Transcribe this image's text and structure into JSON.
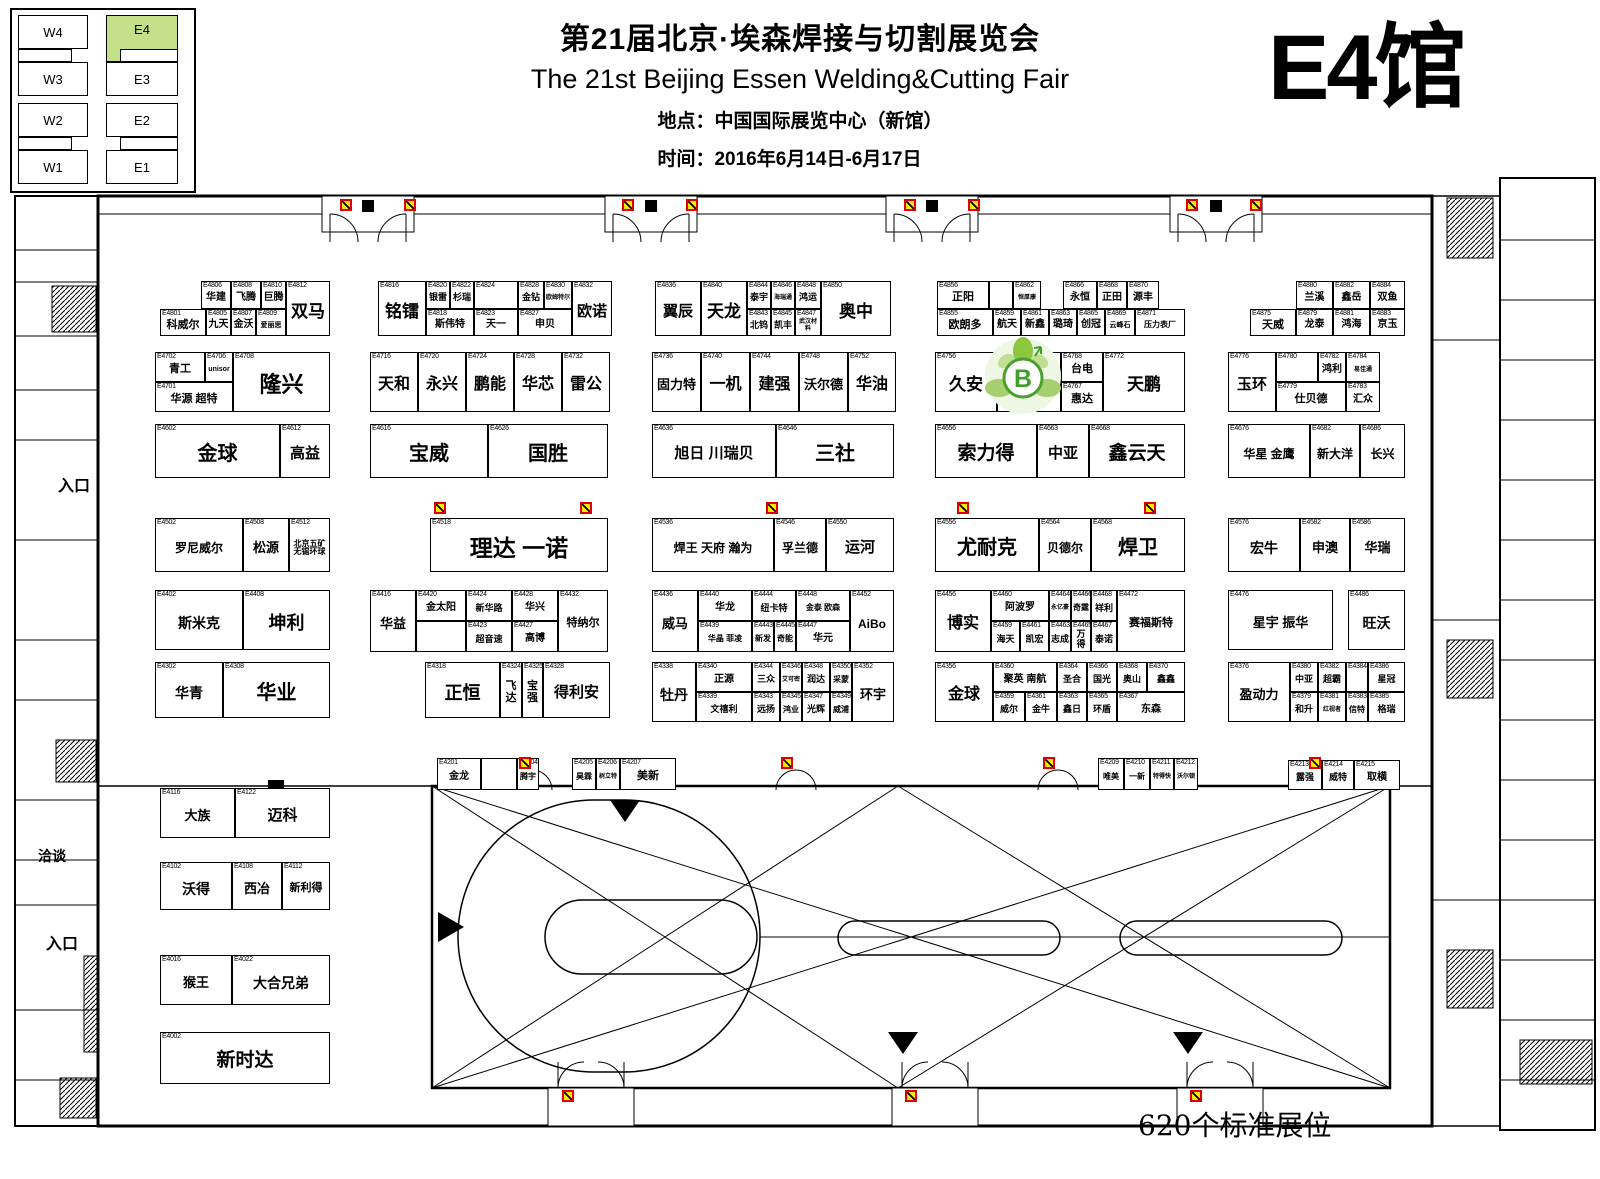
{
  "header": {
    "title_cn": "第21届北京·埃森焊接与切割展览会",
    "title_en": "The 21st Beijing Essen Welding&Cutting Fair",
    "location": "地点：中国国际展览中心（新馆）",
    "dates": "时间：2016年6月14日-6月17日",
    "hall_label": "E4馆"
  },
  "minimap": {
    "halls": [
      {
        "label": "W4"
      },
      {
        "label": "W3"
      },
      {
        "label": "W2"
      },
      {
        "label": "W1"
      },
      {
        "label": "E4"
      },
      {
        "label": "E3"
      },
      {
        "label": "E2"
      },
      {
        "label": "E1"
      }
    ],
    "highlight": "E4"
  },
  "labels": {
    "entrance_top": "入口",
    "meeting": "洽谈",
    "entrance_bottom": "入口",
    "booth_count": "620个标准展位"
  },
  "colors": {
    "minimap_highlight": "#c4e189",
    "hydrant_yellow": "#ffe800",
    "hydrant_red": "#e10000",
    "logo_green": "#7ab648"
  },
  "booths": [
    [
      "E4806",
      "华建",
      201,
      281,
      30,
      28,
      10
    ],
    [
      "E4808",
      "飞腾",
      231,
      281,
      30,
      28,
      10
    ],
    [
      "E4810",
      "巨腾",
      261,
      281,
      25,
      28,
      10
    ],
    [
      "E4812",
      "双马",
      286,
      281,
      44,
      55,
      17
    ],
    [
      "E4801",
      "科威尔",
      160,
      309,
      46,
      27,
      11
    ],
    [
      "E4805",
      "九天",
      206,
      309,
      25,
      27,
      10
    ],
    [
      "E4807",
      "金沃",
      231,
      309,
      25,
      27,
      10
    ],
    [
      "E4809",
      "爱丽思",
      256,
      309,
      30,
      27,
      7
    ],
    [
      "E4816",
      "铭镭",
      378,
      281,
      48,
      55,
      17
    ],
    [
      "E4820",
      "银雷",
      426,
      281,
      24,
      28,
      9
    ],
    [
      "E4822",
      "杉瑞",
      450,
      281,
      24,
      28,
      9
    ],
    [
      "E4824",
      "",
      474,
      281,
      44,
      28,
      9
    ],
    [
      "E4828",
      "金钻",
      518,
      281,
      26,
      28,
      9
    ],
    [
      "E4830",
      "欧姆特尔",
      544,
      281,
      28,
      28,
      6
    ],
    [
      "E4818",
      "斯伟特",
      426,
      309,
      48,
      27,
      10
    ],
    [
      "E4823",
      "天一",
      474,
      309,
      44,
      27,
      10
    ],
    [
      "E4827",
      "申贝",
      518,
      309,
      54,
      27,
      10
    ],
    [
      "E4832",
      "欧诺",
      572,
      281,
      40,
      55,
      15
    ],
    [
      "E4836",
      "翼辰",
      655,
      281,
      46,
      55,
      15
    ],
    [
      "E4840",
      "天龙",
      701,
      281,
      46,
      55,
      17
    ],
    [
      "E4844",
      "泰宇",
      747,
      281,
      24,
      28,
      9
    ],
    [
      "E4846",
      "海瑞通",
      771,
      281,
      24,
      28,
      6
    ],
    [
      "E4848",
      "鸿运",
      795,
      281,
      26,
      28,
      9
    ],
    [
      "E4843",
      "北钨",
      747,
      309,
      24,
      27,
      9
    ],
    [
      "E4845",
      "凯丰",
      771,
      309,
      24,
      27,
      9
    ],
    [
      "E4847",
      "武汉材料",
      795,
      309,
      26,
      27,
      6
    ],
    [
      "E4850",
      "奥中",
      821,
      281,
      70,
      55,
      17
    ],
    [
      "E4856",
      "正阳",
      937,
      281,
      52,
      28,
      11
    ],
    [
      "",
      "",
      989,
      281,
      24,
      28,
      9
    ],
    [
      "E4862",
      "恒厚康",
      1013,
      281,
      28,
      28,
      6
    ],
    [
      "E4866",
      "永恒",
      1063,
      281,
      34,
      28,
      10
    ],
    [
      "E4868",
      "正田",
      1097,
      281,
      30,
      28,
      10
    ],
    [
      "E4870",
      "源丰",
      1127,
      281,
      32,
      28,
      10
    ],
    [
      "E4855",
      "欧朗多",
      937,
      309,
      56,
      27,
      11
    ],
    [
      "E4859",
      "航天",
      993,
      309,
      28,
      27,
      10
    ],
    [
      "E4861",
      "新鑫",
      1021,
      309,
      28,
      27,
      10
    ],
    [
      "E4863",
      "璐琦",
      1049,
      309,
      28,
      27,
      10
    ],
    [
      "E4865",
      "创冠",
      1077,
      309,
      28,
      27,
      10
    ],
    [
      "E4869",
      "云峰石",
      1105,
      309,
      30,
      27,
      7
    ],
    [
      "E4871",
      "压力表厂",
      1135,
      309,
      50,
      27,
      8
    ],
    [
      "E4880",
      "兰溪",
      1296,
      281,
      37,
      28,
      10
    ],
    [
      "E4882",
      "鑫岳",
      1333,
      281,
      37,
      28,
      10
    ],
    [
      "E4884",
      "双鱼",
      1370,
      281,
      35,
      28,
      10
    ],
    [
      "E4875",
      "天威",
      1250,
      309,
      46,
      27,
      11
    ],
    [
      "E4879",
      "龙泰",
      1296,
      309,
      37,
      27,
      10
    ],
    [
      "E4881",
      "鸿海",
      1333,
      309,
      37,
      27,
      10
    ],
    [
      "E4883",
      "京玉",
      1370,
      309,
      35,
      27,
      10
    ],
    [
      "E4702",
      "青工",
      155,
      352,
      50,
      30,
      11
    ],
    [
      "E4706",
      "unisor",
      205,
      352,
      28,
      30,
      7
    ],
    [
      "E4701",
      "华源 超特",
      155,
      382,
      78,
      30,
      11
    ],
    [
      "E4708",
      "隆兴",
      233,
      352,
      97,
      60,
      22
    ],
    [
      "E4716",
      "天和",
      370,
      352,
      48,
      60,
      16
    ],
    [
      "E4720",
      "永兴",
      418,
      352,
      48,
      60,
      16
    ],
    [
      "E4724",
      "鹏能",
      466,
      352,
      48,
      60,
      16
    ],
    [
      "E4728",
      "华芯",
      514,
      352,
      48,
      60,
      16
    ],
    [
      "E4732",
      "雷公",
      562,
      352,
      48,
      60,
      16
    ],
    [
      "E4736",
      "固力特",
      652,
      352,
      49,
      60,
      13
    ],
    [
      "E4740",
      "一机",
      701,
      352,
      49,
      60,
      16
    ],
    [
      "E4744",
      "建强",
      750,
      352,
      49,
      60,
      16
    ],
    [
      "E4748",
      "沃尔德",
      799,
      352,
      49,
      60,
      13
    ],
    [
      "E4752",
      "华油",
      848,
      352,
      48,
      60,
      16
    ],
    [
      "E4756",
      "久安",
      935,
      352,
      62,
      60,
      17
    ],
    [
      "",
      "",
      997,
      352,
      64,
      60,
      10
    ],
    [
      "E4768",
      "台电",
      1061,
      352,
      42,
      30,
      11
    ],
    [
      "E4767",
      "惠达",
      1061,
      382,
      42,
      30,
      11
    ],
    [
      "E4772",
      "天鹏",
      1103,
      352,
      82,
      60,
      17
    ],
    [
      "E4776",
      "玉环",
      1228,
      352,
      48,
      60,
      15
    ],
    [
      "E4780",
      "",
      1276,
      352,
      42,
      30,
      10
    ],
    [
      "E4782",
      "鸿利",
      1318,
      352,
      28,
      30,
      10
    ],
    [
      "E4784",
      "易佳通",
      1346,
      352,
      34,
      30,
      6
    ],
    [
      "E4779",
      "仕贝德",
      1276,
      382,
      70,
      30,
      11
    ],
    [
      "E4783",
      "汇众",
      1346,
      382,
      34,
      30,
      10
    ],
    [
      "E4602",
      "金球",
      155,
      424,
      125,
      54,
      20
    ],
    [
      "E4612",
      "高益",
      280,
      424,
      50,
      54,
      15
    ],
    [
      "E4616",
      "宝威",
      370,
      424,
      118,
      54,
      20
    ],
    [
      "E4626",
      "国胜",
      488,
      424,
      120,
      54,
      20
    ],
    [
      "E4636",
      "旭日 川瑞贝",
      652,
      424,
      124,
      54,
      15
    ],
    [
      "E4646",
      "三社",
      776,
      424,
      118,
      54,
      20
    ],
    [
      "E4656",
      "索力得",
      935,
      424,
      102,
      54,
      19
    ],
    [
      "E4663",
      "中亚",
      1037,
      424,
      52,
      54,
      15
    ],
    [
      "E4668",
      "鑫云天",
      1089,
      424,
      96,
      54,
      19
    ],
    [
      "E4676",
      "华星 金鹰",
      1228,
      424,
      82,
      54,
      12
    ],
    [
      "E4682",
      "新大洋",
      1310,
      424,
      50,
      54,
      12
    ],
    [
      "E4686",
      "长兴",
      1360,
      424,
      45,
      54,
      12
    ],
    [
      "E4502",
      "罗尼威尔",
      155,
      518,
      88,
      54,
      12
    ],
    [
      "E4508",
      "松源",
      243,
      518,
      46,
      54,
      13
    ],
    [
      "E4512",
      "北京五矿 无锡环球",
      289,
      518,
      41,
      54,
      8
    ],
    [
      "E4518",
      "理达 一诺",
      430,
      518,
      178,
      54,
      23
    ],
    [
      "E4536",
      "焊王 天府 瀚为",
      652,
      518,
      122,
      54,
      12
    ],
    [
      "E4546",
      "孚兰德",
      774,
      518,
      52,
      54,
      12
    ],
    [
      "E4550",
      "运河",
      826,
      518,
      68,
      54,
      15
    ],
    [
      "E4556",
      "尤耐克",
      935,
      518,
      104,
      54,
      20
    ],
    [
      "E4564",
      "贝德尔",
      1039,
      518,
      52,
      54,
      12
    ],
    [
      "E4568",
      "焊卫",
      1091,
      518,
      94,
      54,
      20
    ],
    [
      "E4576",
      "宏牛",
      1228,
      518,
      72,
      54,
      14
    ],
    [
      "E4582",
      "申澳",
      1300,
      518,
      50,
      54,
      13
    ],
    [
      "E4586",
      "华瑞",
      1350,
      518,
      55,
      54,
      13
    ],
    [
      "E4402",
      "斯米克",
      155,
      590,
      88,
      60,
      14
    ],
    [
      "E4408",
      "坤利",
      243,
      590,
      87,
      60,
      18
    ],
    [
      "E4416",
      "华益",
      370,
      590,
      46,
      62,
      13
    ],
    [
      "E4420",
      "金太阳",
      416,
      590,
      50,
      31,
      10
    ],
    [
      "E4424",
      "新华路",
      466,
      590,
      46,
      31,
      9
    ],
    [
      "E4428",
      "华兴",
      512,
      590,
      46,
      31,
      10
    ],
    [
      "",
      "",
      416,
      621,
      50,
      31,
      9
    ],
    [
      "E4423",
      "超音速",
      466,
      621,
      46,
      31,
      9
    ],
    [
      "E4427",
      "高博",
      512,
      621,
      46,
      31,
      10
    ],
    [
      "E4432",
      "特纳尔",
      558,
      590,
      50,
      62,
      11
    ],
    [
      "E4436",
      "威马",
      652,
      590,
      46,
      62,
      13
    ],
    [
      "E4440",
      "华龙",
      698,
      590,
      54,
      31,
      10
    ],
    [
      "E4444",
      "纽卡特",
      752,
      590,
      44,
      31,
      9
    ],
    [
      "E4448",
      "金泰 欧森",
      796,
      590,
      54,
      31,
      8
    ],
    [
      "E4439",
      "华晶 菲凌",
      698,
      621,
      54,
      31,
      8
    ],
    [
      "E4443",
      "新发",
      752,
      621,
      22,
      31,
      8
    ],
    [
      "E4445",
      "奇能",
      774,
      621,
      22,
      31,
      8
    ],
    [
      "E4447",
      "华元",
      796,
      621,
      54,
      31,
      10
    ],
    [
      "E4452",
      "AiBo",
      850,
      590,
      44,
      62,
      12
    ],
    [
      "E4456",
      "博实",
      935,
      590,
      56,
      62,
      16
    ],
    [
      "E4460",
      "阿波罗",
      991,
      590,
      58,
      31,
      10
    ],
    [
      "E4464",
      "永亿豪",
      1049,
      590,
      22,
      31,
      6
    ],
    [
      "E4466",
      "奇霆",
      1071,
      590,
      20,
      31,
      8
    ],
    [
      "E4468",
      "祥利",
      1091,
      590,
      26,
      31,
      9
    ],
    [
      "E4459",
      "海天",
      991,
      621,
      29,
      31,
      9
    ],
    [
      "E4461",
      "凯宏",
      1020,
      621,
      29,
      31,
      9
    ],
    [
      "E4463",
      "志成",
      1049,
      621,
      22,
      31,
      9
    ],
    [
      "E4465",
      "万得",
      1071,
      621,
      20,
      31,
      9
    ],
    [
      "E4467",
      "泰诺",
      1091,
      621,
      26,
      31,
      9
    ],
    [
      "E4472",
      "赛福斯特",
      1117,
      590,
      68,
      62,
      11
    ],
    [
      "E4476",
      "星宇 振华",
      1228,
      590,
      105,
      60,
      13
    ],
    [
      "E4486",
      "旺沃",
      1348,
      590,
      57,
      60,
      14
    ],
    [
      "E4302",
      "华青",
      155,
      662,
      68,
      56,
      14
    ],
    [
      "E4308",
      "华业",
      223,
      662,
      107,
      56,
      20
    ],
    [
      "E4318",
      "正恒",
      425,
      662,
      75,
      56,
      18
    ],
    [
      "E4324",
      "飞达",
      500,
      662,
      22,
      56,
      11
    ],
    [
      "E4325",
      "宝强",
      522,
      662,
      21,
      56,
      11
    ],
    [
      "E4328",
      "得利安",
      543,
      662,
      67,
      56,
      15
    ],
    [
      "E4338",
      "牡丹",
      652,
      662,
      44,
      60,
      14
    ],
    [
      "E4340",
      "正源",
      696,
      662,
      56,
      30,
      10
    ],
    [
      "E4344",
      "三众",
      752,
      662,
      28,
      30,
      9
    ],
    [
      "E4346",
      "艾可密",
      780,
      662,
      22,
      30,
      6
    ],
    [
      "E4348",
      "润达",
      802,
      662,
      28,
      30,
      9
    ],
    [
      "E4350",
      "采蒙",
      830,
      662,
      22,
      30,
      8
    ],
    [
      "E4339",
      "文禧利",
      696,
      692,
      56,
      30,
      9
    ],
    [
      "E4343",
      "远扬",
      752,
      692,
      28,
      30,
      9
    ],
    [
      "E4345",
      "鸿业",
      780,
      692,
      22,
      30,
      8
    ],
    [
      "E4347",
      "光辉",
      802,
      692,
      28,
      30,
      9
    ],
    [
      "E4349",
      "威浦",
      830,
      692,
      22,
      30,
      8
    ],
    [
      "E4352",
      "环宇",
      852,
      662,
      42,
      60,
      13
    ],
    [
      "E4356",
      "金球",
      935,
      662,
      58,
      60,
      16
    ],
    [
      "E4360",
      "聚英 南航",
      993,
      662,
      64,
      30,
      10
    ],
    [
      "E4364",
      "圣合",
      1057,
      662,
      30,
      30,
      9
    ],
    [
      "E4366",
      "国光",
      1087,
      662,
      30,
      30,
      9
    ],
    [
      "E4368",
      "奥山",
      1117,
      662,
      30,
      30,
      9
    ],
    [
      "E4370",
      "鑫鑫",
      1147,
      662,
      38,
      30,
      9
    ],
    [
      "E4359",
      "威尔",
      993,
      692,
      32,
      30,
      9
    ],
    [
      "E4361",
      "金牛",
      1025,
      692,
      32,
      30,
      9
    ],
    [
      "E4363",
      "鑫日",
      1057,
      692,
      30,
      30,
      9
    ],
    [
      "E4365",
      "环盾",
      1087,
      692,
      30,
      30,
      9
    ],
    [
      "E4367",
      "东森",
      1117,
      692,
      68,
      30,
      10
    ],
    [
      "E4376",
      "盈动力",
      1228,
      662,
      62,
      60,
      13
    ],
    [
      "E4380",
      "中亚",
      1290,
      662,
      28,
      30,
      9
    ],
    [
      "E4382",
      "超霸",
      1318,
      662,
      28,
      30,
      9
    ],
    [
      "E4384",
      "",
      1346,
      662,
      22,
      30,
      9
    ],
    [
      "E4386",
      "星冠",
      1368,
      662,
      37,
      30,
      9
    ],
    [
      "E4379",
      "和升",
      1290,
      692,
      28,
      30,
      9
    ],
    [
      "E4381",
      "红视者",
      1318,
      692,
      28,
      30,
      6
    ],
    [
      "E4383",
      "信特",
      1346,
      692,
      22,
      30,
      8
    ],
    [
      "E4385",
      "格瑞",
      1368,
      692,
      37,
      30,
      9
    ],
    [
      "E4201",
      "金龙",
      437,
      758,
      44,
      32,
      10
    ],
    [
      "",
      "",
      481,
      758,
      36,
      32,
      9
    ],
    [
      "E4204",
      "腾宇",
      517,
      758,
      22,
      32,
      8
    ],
    [
      "E4205",
      "昊霖",
      572,
      758,
      24,
      32,
      8
    ],
    [
      "E4206",
      "树立特",
      596,
      758,
      24,
      32,
      6
    ],
    [
      "E4207",
      "美新",
      620,
      758,
      56,
      32,
      11
    ],
    [
      "E4209",
      "唯美",
      1098,
      758,
      26,
      32,
      8
    ],
    [
      "E4210",
      "一新",
      1124,
      758,
      26,
      32,
      8
    ],
    [
      "E4211",
      "特得快",
      1150,
      758,
      24,
      32,
      6
    ],
    [
      "E4212",
      "沃尔顿",
      1174,
      758,
      24,
      32,
      6
    ],
    [
      "E4213",
      "露强",
      1288,
      760,
      34,
      30,
      9
    ],
    [
      "E4214",
      "威特",
      1322,
      760,
      32,
      30,
      9
    ],
    [
      "E4215",
      "取横",
      1354,
      760,
      46,
      30,
      10
    ],
    [
      "E4116",
      "大族",
      160,
      788,
      75,
      50,
      13
    ],
    [
      "E4122",
      "迈科",
      235,
      788,
      95,
      50,
      15
    ],
    [
      "E4102",
      "沃得",
      160,
      862,
      72,
      48,
      14
    ],
    [
      "E4108",
      "西冶",
      232,
      862,
      50,
      48,
      13
    ],
    [
      "E4112",
      "新利得",
      282,
      862,
      48,
      48,
      11
    ],
    [
      "E4016",
      "猴王",
      160,
      955,
      72,
      50,
      13
    ],
    [
      "E4022",
      "大合兄弟",
      232,
      955,
      98,
      50,
      14
    ],
    [
      "E4002",
      "新时达",
      160,
      1032,
      170,
      52,
      19
    ]
  ]
}
